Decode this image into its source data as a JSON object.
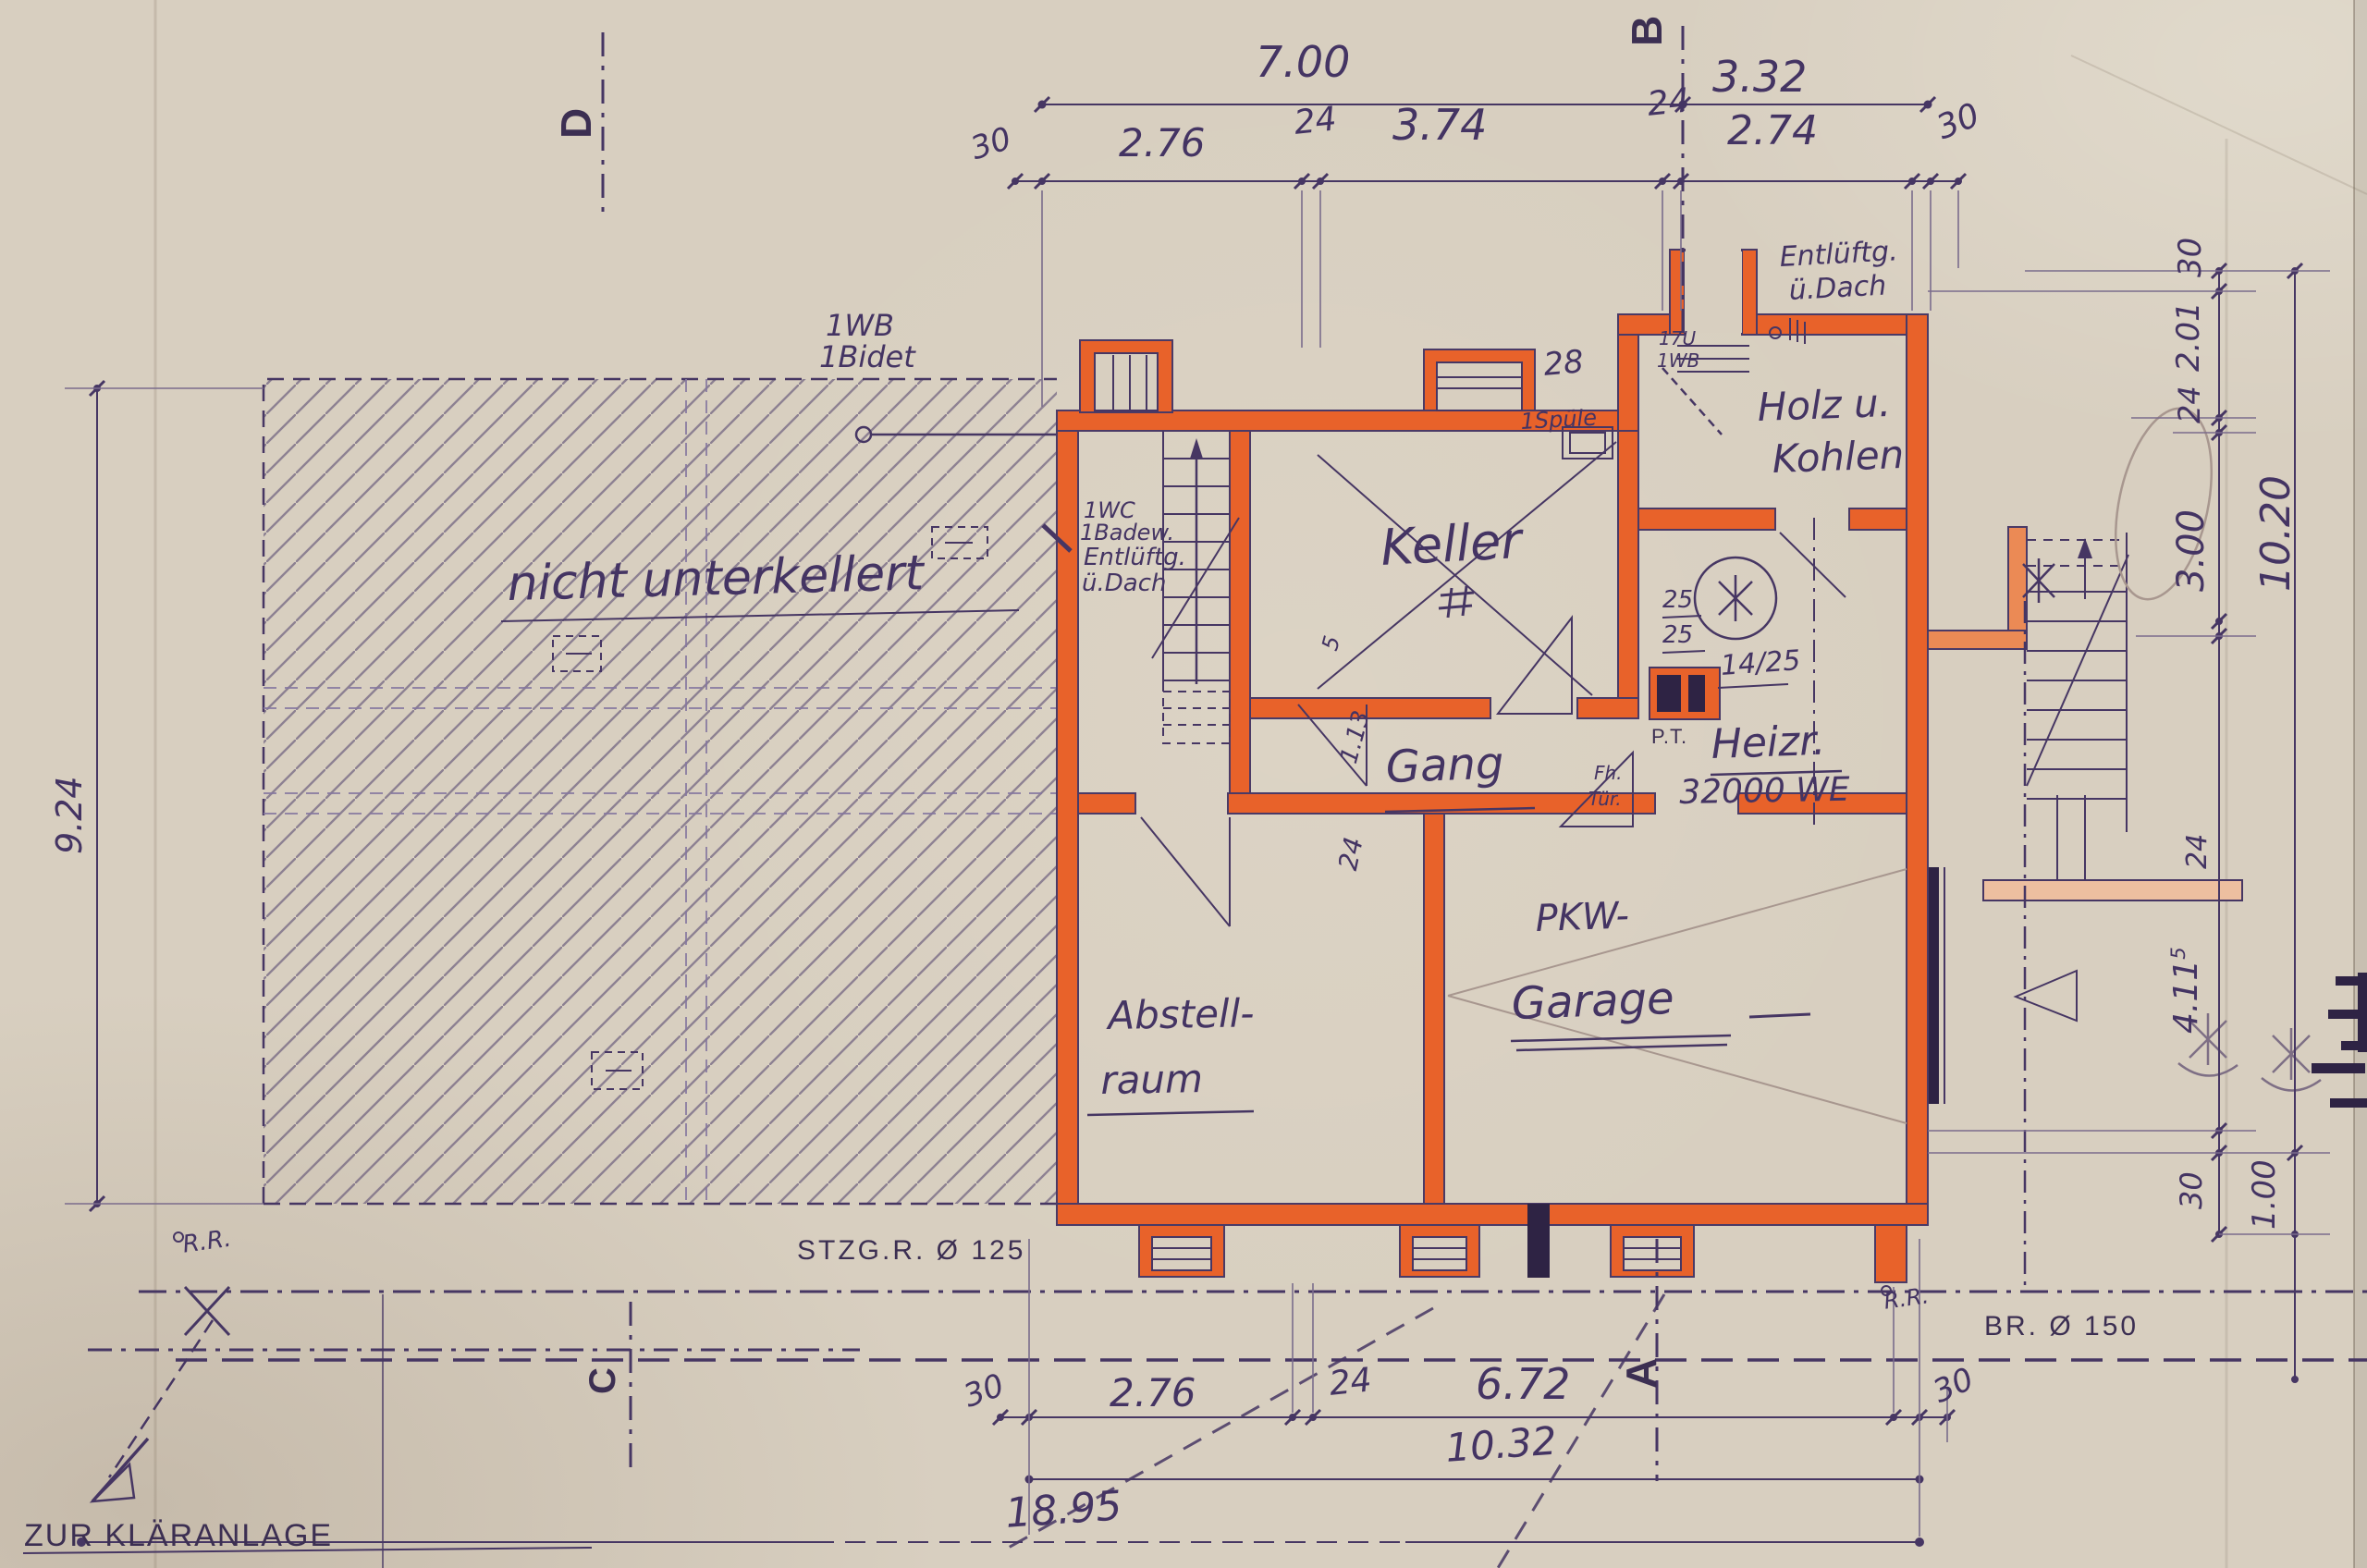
{
  "colors": {
    "paper": "#d8cfc0",
    "ink": "#463663",
    "wall_orange": "#e8622a",
    "wall_orange_light": "#eb8a55",
    "pencil": "#a8978f"
  },
  "markers": {
    "d": "D",
    "b": "B",
    "c": "C",
    "a": "A"
  },
  "rooms": {
    "keller": "Keller",
    "gang": "Gang",
    "heizr": "Heizr.",
    "heiz_we": "32000 WE",
    "holz1": "Holz u.",
    "holz2": "Kohlen",
    "abstell1": "Abstell-",
    "abstell2": "raum",
    "garage1": "PKW-",
    "garage2": "Garage"
  },
  "labels": {
    "wb": "1WB",
    "bidet": "1Bidet",
    "wc": "1WC",
    "badew": "1Badew.",
    "entl1": "Entlüftg.",
    "entl1b": "ü.Dach",
    "entl2": "Entlüftg.",
    "entl2b": "ü.Dach",
    "spuele": "1Spüle",
    "n28": "28",
    "tu17": "17U",
    "wb2": "1WB",
    "nicht": "nicht unterkellert",
    "fh": "Fh.",
    "tuer": "Tür.",
    "pt": "P.T.",
    "v25a": "25",
    "v25b": "25",
    "v1425": "14/25",
    "d5": "5",
    "d113": "1.13",
    "d24door": "24",
    "rr1": "R.R.",
    "rr2": "R.R.",
    "stzg": "STZG.R. Ø 125",
    "br": "BR. Ø 150",
    "klaer": "ZUR KLÄRANLAGE"
  },
  "dims_top": {
    "a": "7.00",
    "b": "3.32",
    "c": "30",
    "d": "2.76",
    "e": "24",
    "f": "3.74",
    "g": "24",
    "h": "2.74",
    "i": "30"
  },
  "dims_bottom": {
    "a": "30",
    "b": "2.76",
    "c": "24",
    "d": "6.72",
    "e": "30",
    "f": "10.32",
    "g": "18.95"
  },
  "dims_left": {
    "a": "9.24"
  },
  "dims_right": {
    "a": "30",
    "b": "2.01",
    "c": "24",
    "d": "3.00",
    "e": "10.20",
    "f": "24",
    "g": "4.11",
    "gsup": "5",
    "h": "30",
    "i": "1.00"
  }
}
